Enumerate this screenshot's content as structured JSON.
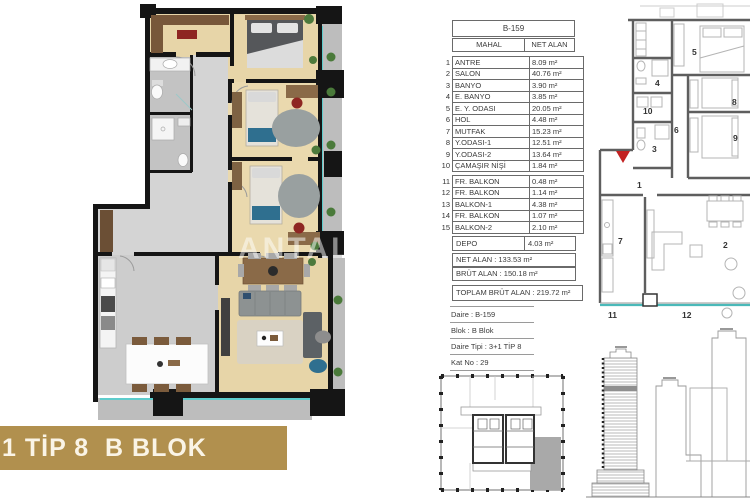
{
  "banner": {
    "label": "1 TİP 8  B BLOK",
    "color": "#b1904e"
  },
  "watermark": {
    "text": "ANTAL"
  },
  "unit_table": {
    "title": "B-159",
    "col_room": "MAHAL",
    "col_area": "NET ALAN",
    "rows": [
      {
        "no": "1",
        "name": "ANTRE",
        "area": "8.09 m²"
      },
      {
        "no": "2",
        "name": "SALON",
        "area": "40.76 m²"
      },
      {
        "no": "3",
        "name": "BANYO",
        "area": "3.90 m²"
      },
      {
        "no": "4",
        "name": "E. BANYO",
        "area": "3.85 m²"
      },
      {
        "no": "5",
        "name": "E. Y. ODASI",
        "area": "20.05 m²"
      },
      {
        "no": "6",
        "name": "HOL",
        "area": "4.48 m²"
      },
      {
        "no": "7",
        "name": "MUTFAK",
        "area": "15.23 m²"
      },
      {
        "no": "8",
        "name": "Y.ODASI-1",
        "area": "12.51 m²"
      },
      {
        "no": "9",
        "name": "Y.ODASI-2",
        "area": "13.64 m²"
      },
      {
        "no": "10",
        "name": "ÇAMAŞIR NİŞİ",
        "area": "1.84 m²"
      }
    ],
    "balcony_rows": [
      {
        "no": "11",
        "name": "FR. BALKON",
        "area": "0.48 m²"
      },
      {
        "no": "12",
        "name": "FR. BALKON",
        "area": "1.14 m²"
      },
      {
        "no": "13",
        "name": "BALKON-1",
        "area": "4.38 m²"
      },
      {
        "no": "14",
        "name": "FR. BALKON",
        "area": "1.07 m²"
      },
      {
        "no": "15",
        "name": "BALKON-2",
        "area": "2.10 m²"
      }
    ],
    "depo_row": {
      "name": "DEPO",
      "area": "4.03 m²"
    },
    "totals": {
      "net": "NET ALAN : 133.53 m²",
      "brut": "BRÜT ALAN : 150.18 m²",
      "toplam": "TOPLAM BRÜT ALAN : 219.72 m²"
    },
    "info": [
      "Daire : B-159",
      "Blok : B Blok",
      "Daire Tipi : 3+1 TİP 8",
      "Kat No : 29"
    ]
  },
  "plan_labels": [
    "1",
    "2",
    "3",
    "4",
    "5",
    "6",
    "7",
    "8",
    "9",
    "10",
    "11",
    "12"
  ],
  "colors": {
    "accent_teal": "#4ab9b9",
    "marker_red": "#c22222",
    "unit_highlight_gray": "#a9a9a9",
    "wood_floor": "#e7d5a8"
  }
}
